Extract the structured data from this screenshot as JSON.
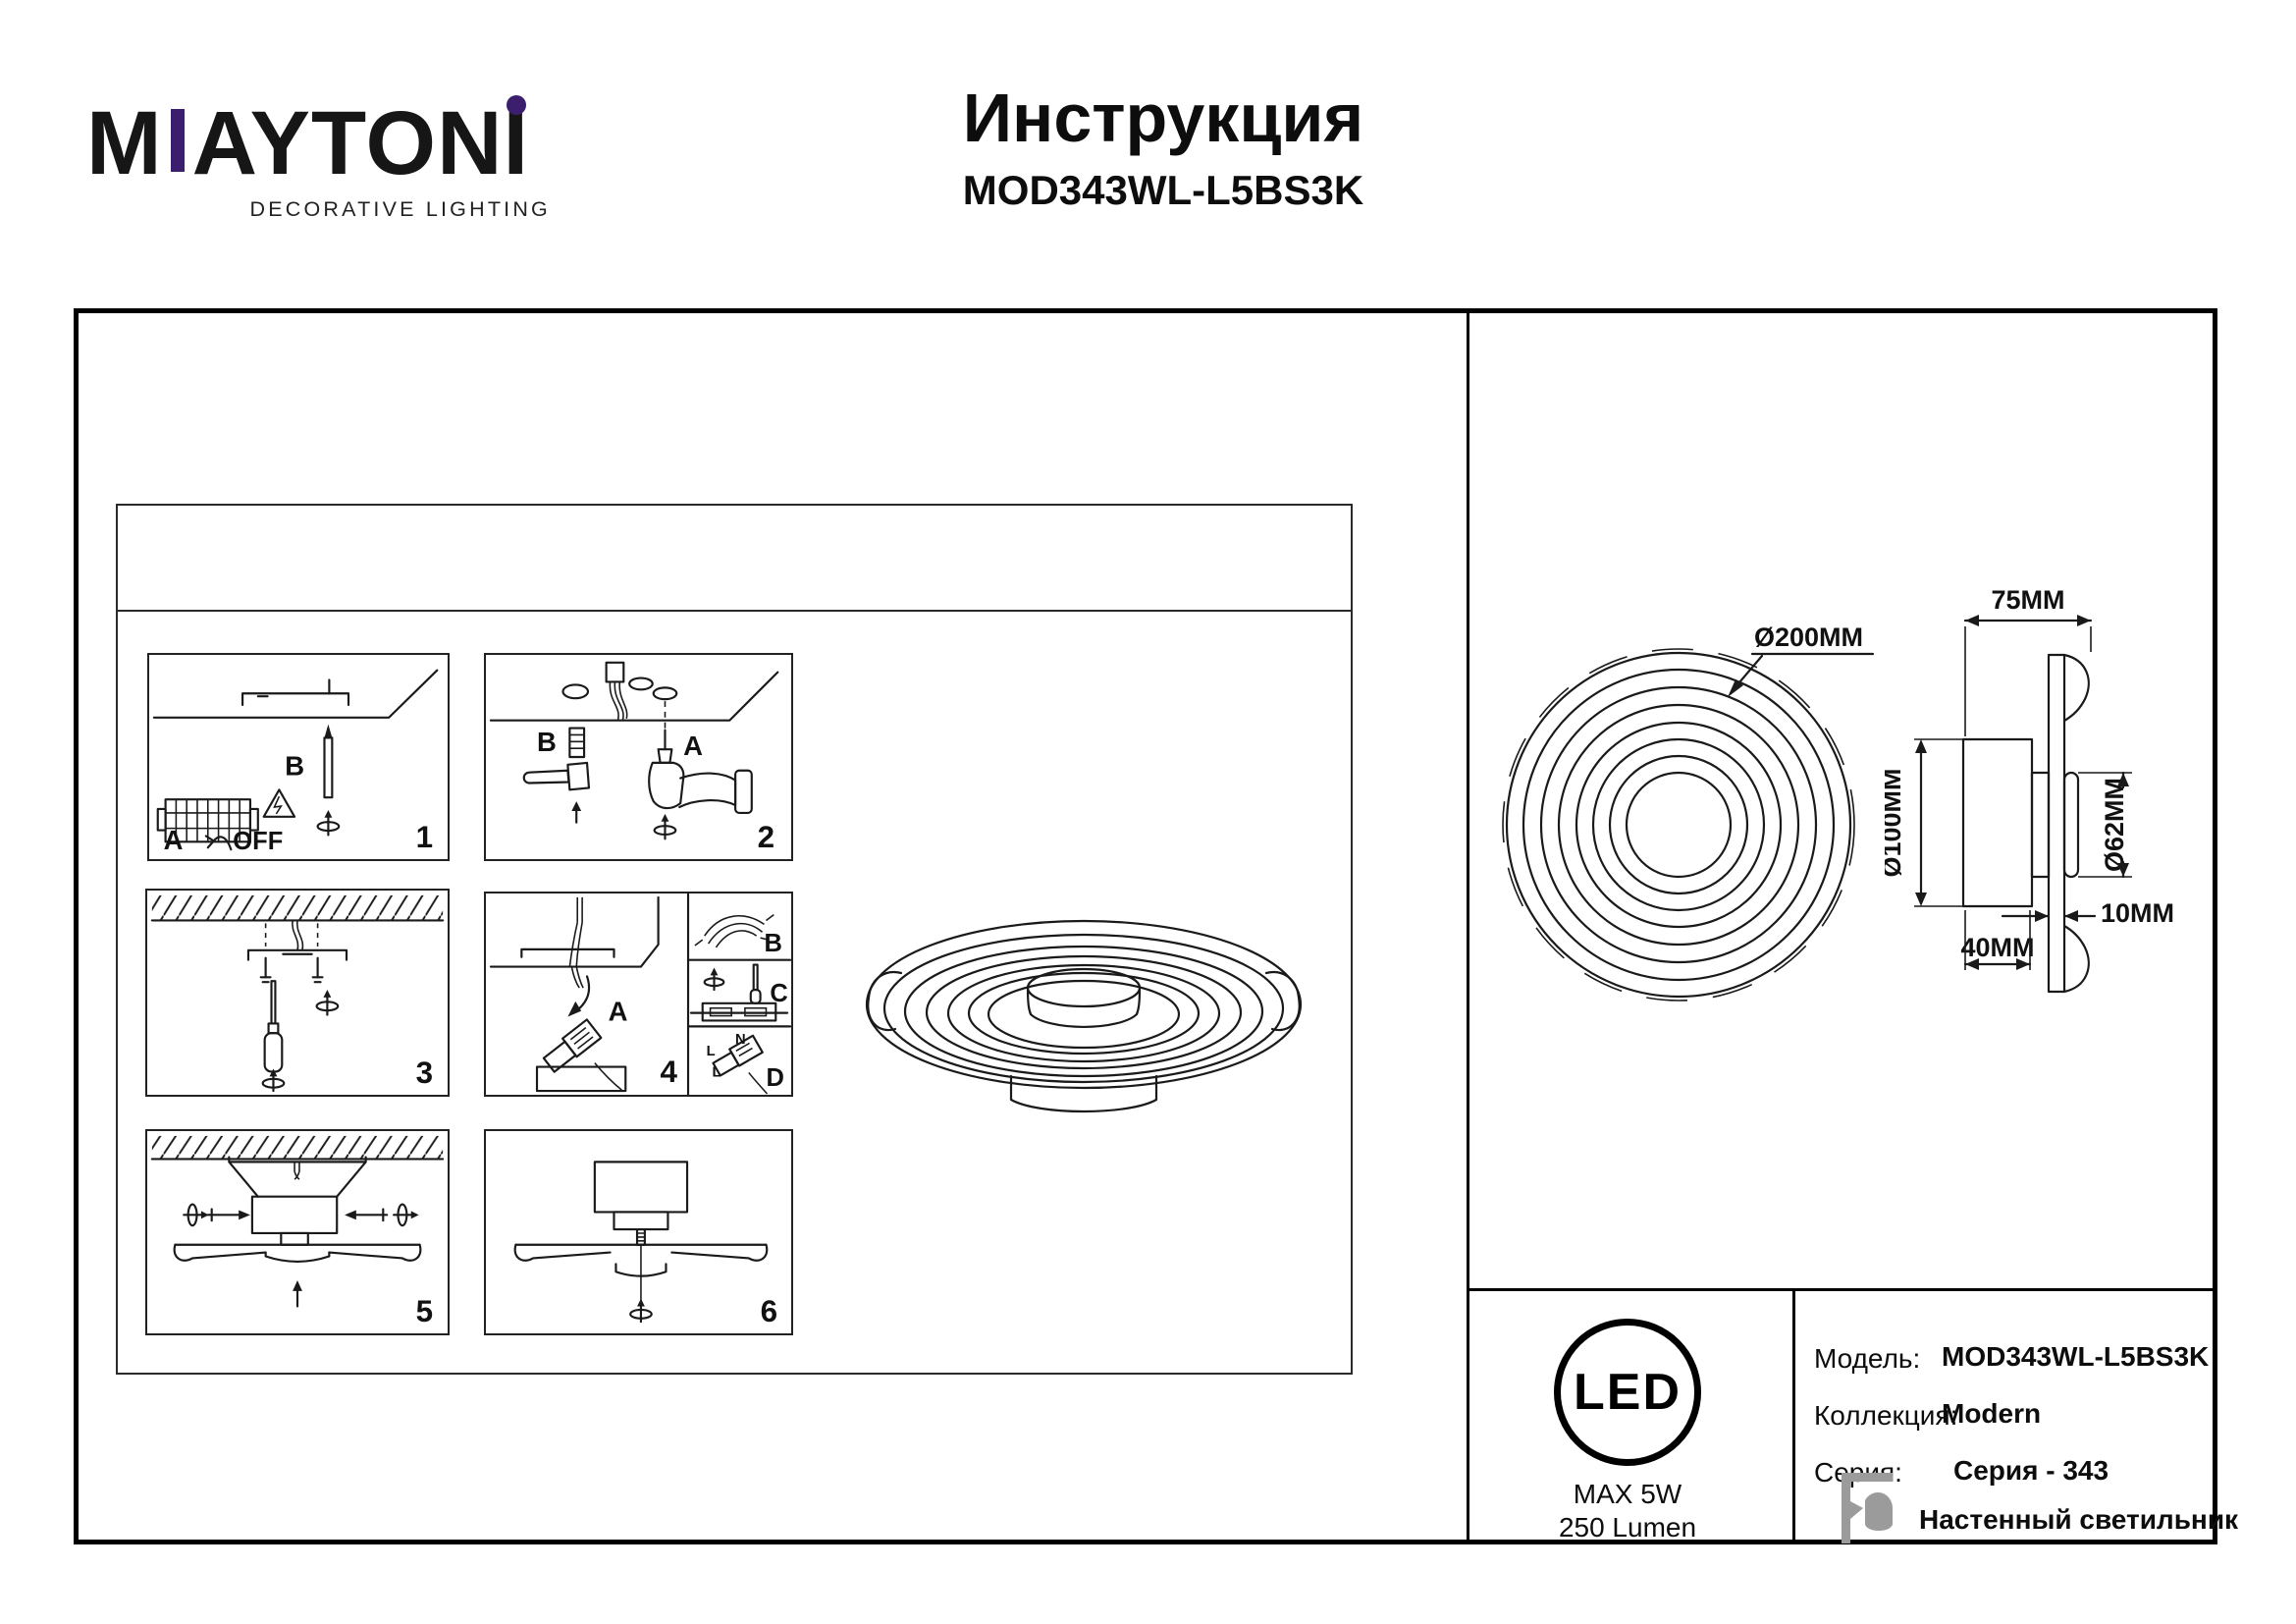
{
  "brand": {
    "part_m": "M",
    "part_mid": "AYTON",
    "part_i": "I",
    "tagline": "DECORATIVE LIGHTING",
    "accent_color": "#3b1f6e"
  },
  "doc": {
    "title": "Инструкция",
    "model": "MOD343WL-L5BS3K"
  },
  "steps": {
    "s1": {
      "num": "1",
      "label_a": "A",
      "label_b": "B",
      "switch_off": "OFF"
    },
    "s2": {
      "num": "2",
      "label_a": "A",
      "label_b": "B"
    },
    "s3": {
      "num": "3"
    },
    "s4": {
      "num": "4",
      "label_a": "A",
      "label_b": "B",
      "label_c": "C",
      "label_d": "D",
      "terminal_l1": "L",
      "terminal_n": "N",
      "terminal_l2": "L"
    },
    "s5": {
      "num": "5"
    },
    "s6": {
      "num": "6"
    }
  },
  "dims": {
    "front_diameter": "Ø200MM",
    "depth": "75MM",
    "base_diameter": "Ø100MM",
    "ring_diameter": "Ø62MM",
    "plate_thickness": "10MM",
    "base_depth": "40MM"
  },
  "spec": {
    "led_badge": "LED",
    "max_power": "MAX 5W",
    "luminous_flux": "250 Lumen",
    "model_label": "Модель:",
    "model_value": "MOD343WL-L5BS3K",
    "collection_label": "Коллекция:",
    "collection_value": "Modern",
    "series_label": "Серия:",
    "series_value": "Серия - 343",
    "type_value": "Настенный светильник"
  }
}
